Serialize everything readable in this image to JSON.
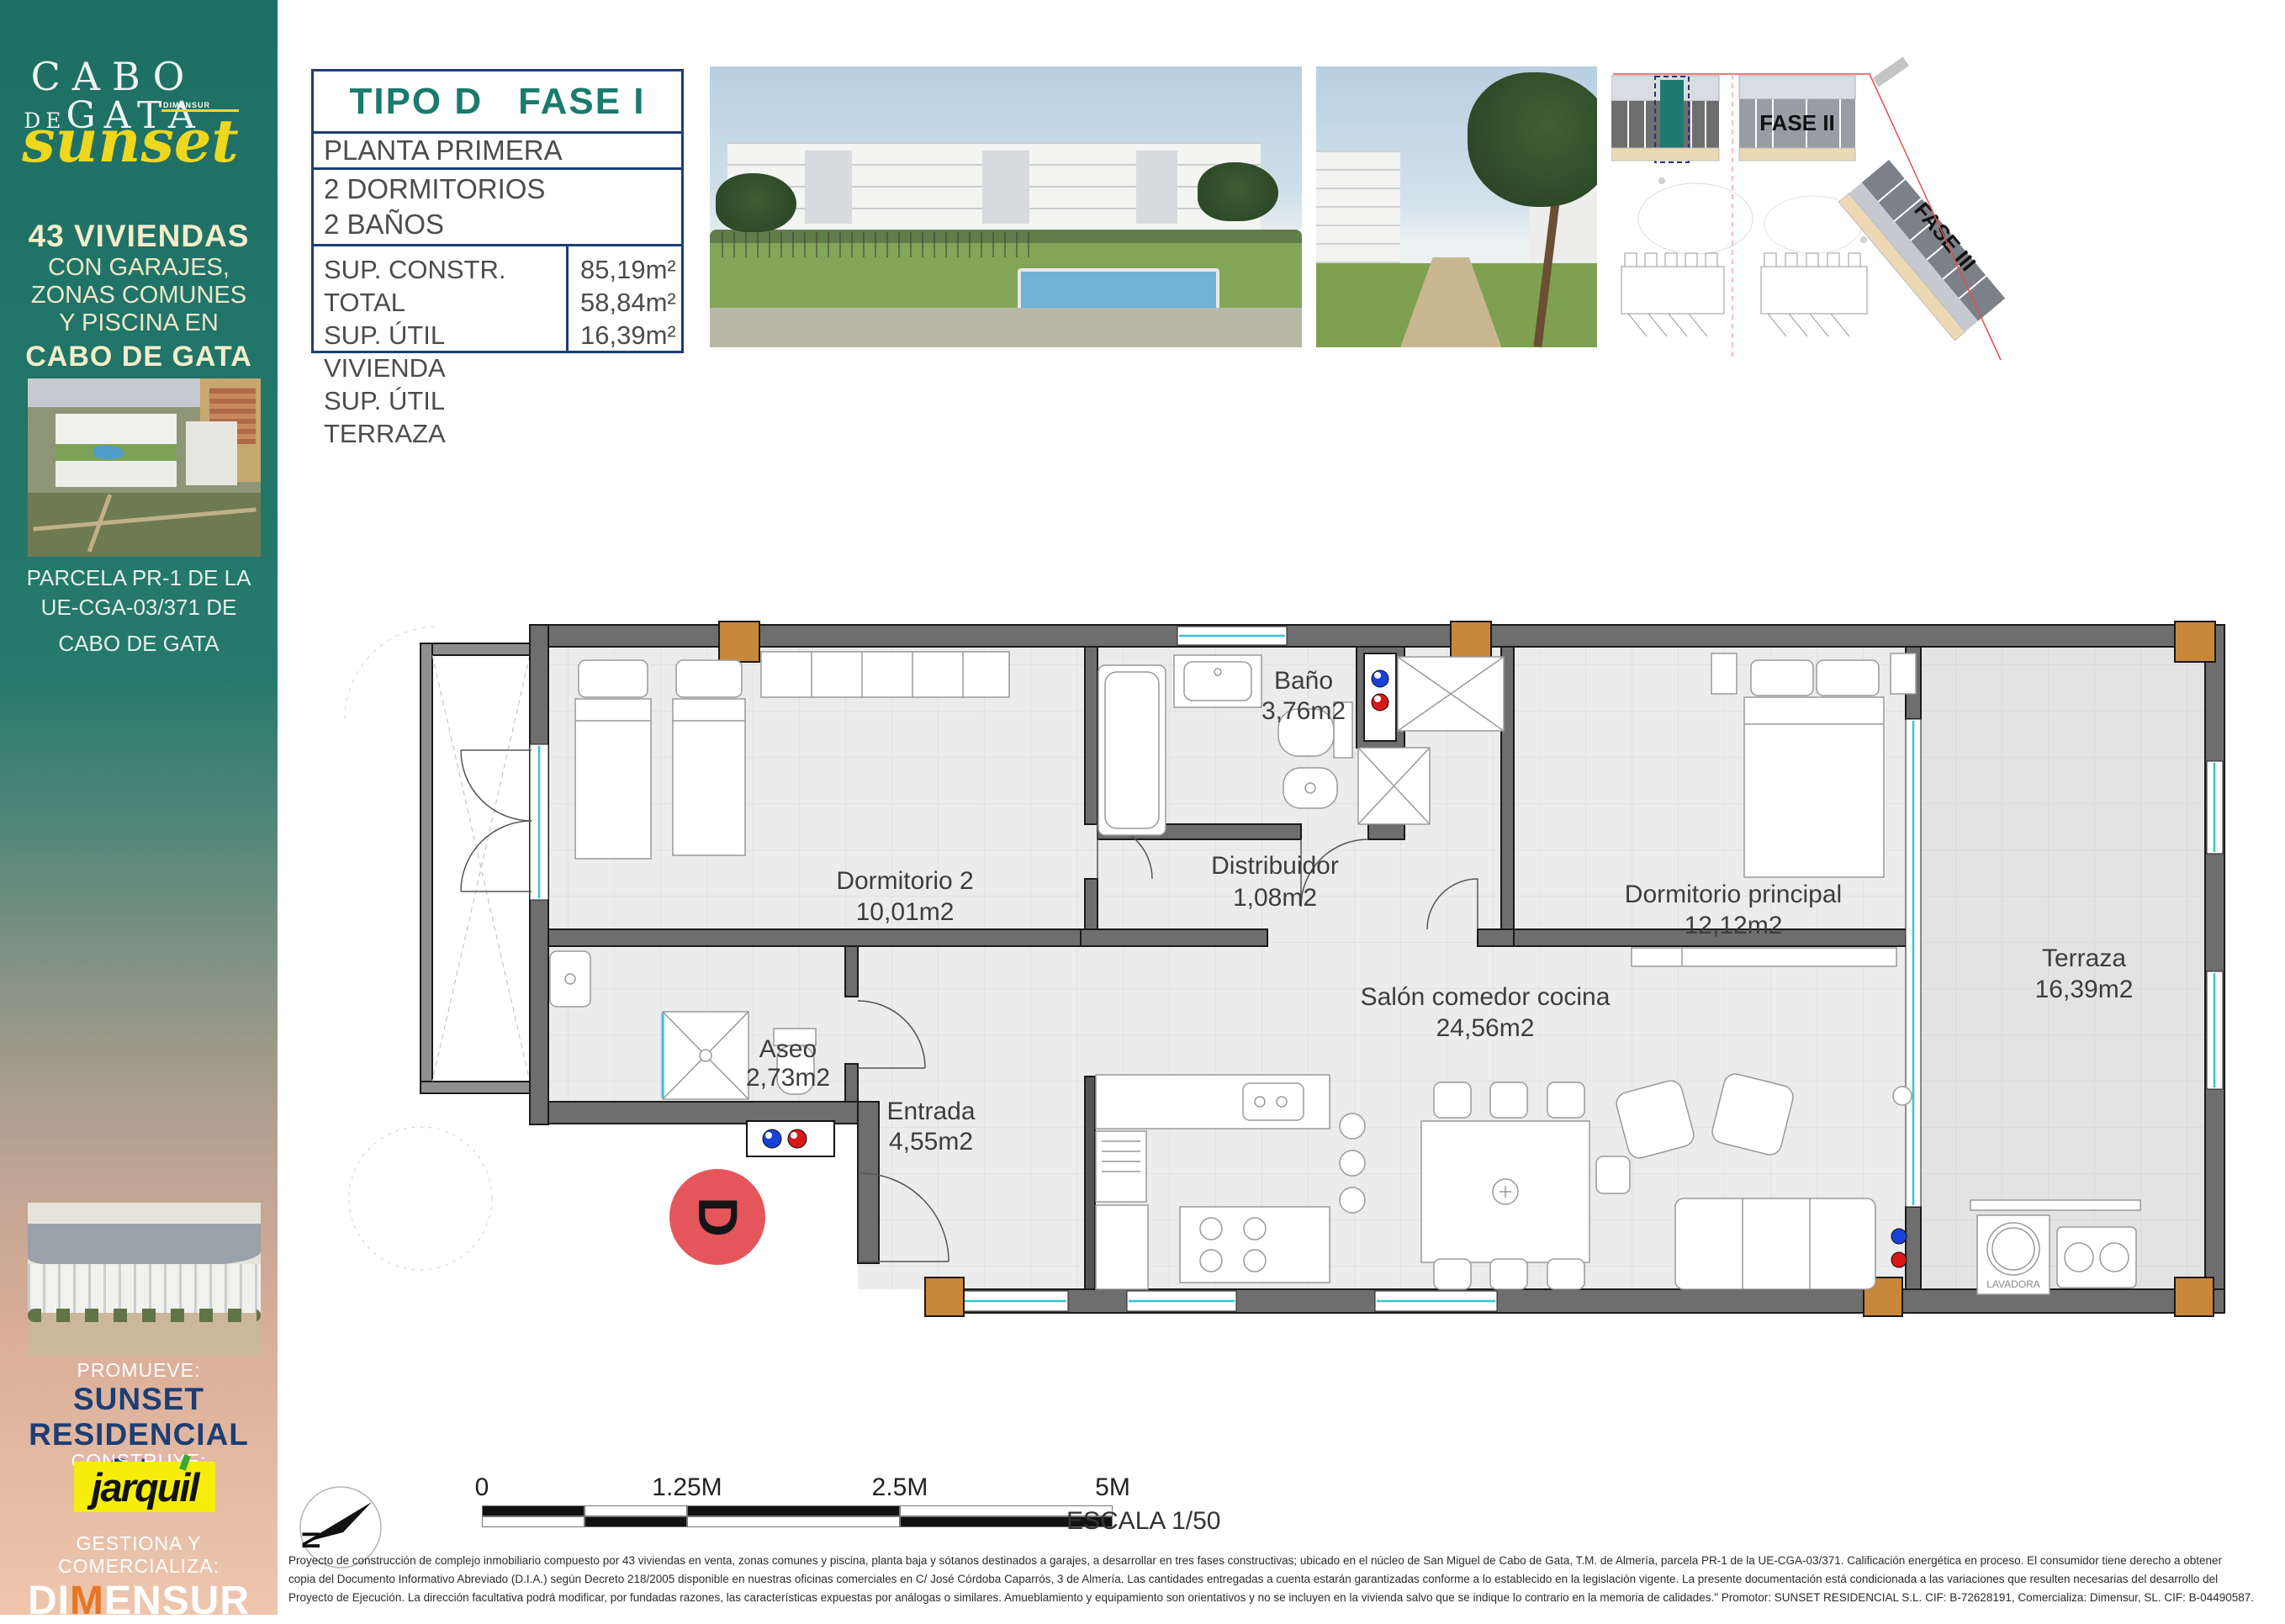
{
  "sidebar": {
    "logo": {
      "cabo": "CABO",
      "de": "DE",
      "gata": "GATA",
      "script": "sunset",
      "byline": "DIMENSUR"
    },
    "headline": {
      "l1": "43 VIVIENDAS",
      "l2": "CON GARAJES,",
      "l3": "ZONAS COMUNES",
      "l4": "Y PISCINA EN",
      "l5": "CABO DE GATA"
    },
    "parcel": {
      "l1": "PARCELA PR-1 DE LA",
      "l2": "UE-CGA-03/371 DE",
      "l3": "CABO DE GATA"
    },
    "promueve_label": "PROMUEVE:",
    "promoter_l1": "SUNSET",
    "promoter_l2": "RESIDENCIAL S.L.",
    "construye_label": "CONSTRUYE:",
    "builder_parts": {
      "a": "jarqu",
      "b": "i",
      "c": "l"
    },
    "gestiona_label": "GESTIONA Y COMERCIALIZA:",
    "agency_parts": {
      "a": "DI",
      "b": "M",
      "c": "ENSUR"
    }
  },
  "info_box": {
    "type_label": "TIPO D",
    "phase_label": "FASE I",
    "floor_label": "PLANTA PRIMERA",
    "bedrooms": "2 DORMITORIOS",
    "bathrooms": "2 BAÑOS",
    "areas": [
      {
        "label": "SUP. CONSTR. TOTAL",
        "value": "85,19m²"
      },
      {
        "label": "SUP. ÚTIL VIVIENDA",
        "value": "58,84m²"
      },
      {
        "label": "SUP. ÚTIL TERRAZA",
        "value": "16,39m²"
      }
    ]
  },
  "site_plan": {
    "fase2_label": "FASE II",
    "fase3_label": "FASE III"
  },
  "floor_plan": {
    "rooms": [
      {
        "name": "Baño",
        "area": "3,76m2"
      },
      {
        "name": "Distribuidor",
        "area": "1,08m2"
      },
      {
        "name": "Dormitorio 2",
        "area": "10,01m2"
      },
      {
        "name": "Dormitorio principal",
        "area": "12,12m2"
      },
      {
        "name": "Salón comedor cocina",
        "area": "24,56m2"
      },
      {
        "name": "Terraza",
        "area": "16,39m2"
      },
      {
        "name": "Aseo",
        "area": "2,73m2"
      },
      {
        "name": "Entrada",
        "area": "4,55m2"
      }
    ],
    "unit_badge": "D",
    "lavadora_label": "LAVADORA"
  },
  "scale_bar": {
    "north_letter": "N",
    "t0": "0",
    "t1": "1.25M",
    "t2": "2.5M",
    "t3": "5M",
    "escala_label": "ESCALA 1/50"
  },
  "disclaimer": {
    "l1": "Proyecto de construcción de complejo inmobiliario compuesto por 43 viviendas en venta, zonas comunes y piscina, planta baja y sótanos destinados a garajes, a desarrollar en tres fases constructivas; ubicado en el núcleo de San Miguel de Cabo de Gata, T.M. de Almería, parcela PR-1 de la UE-CGA-03/371. Calificación energética en proceso. El consumidor tiene derecho a obtener",
    "l2": "copia del Documento Informativo Abreviado (D.I.A.) según Decreto 218/2005 disponible en nuestras oficinas comerciales en C/ José Córdoba Caparrós, 3 de Almería. Las cantidades entregadas a cuenta estarán garantizadas conforme a lo establecido en la legislación vigente. La presente documentación está condicionada a las variaciones que resulten necesarias del desarrollo del",
    "l3": "Proyecto de Ejecución. La dirección facultativa podrá modificar, por fundadas razones, las características expuestas por análogas o similares. Amueblamiento y equipamiento son orientativos y no se incluyen en la vivienda salvo que se indique lo contrario en la memoria de calidades.\" Promotor: SUNSET RESIDENCIAL S.L. CIF: B-72628191, Comercializa: Dimensur, SL. CIF: B-04490587."
  },
  "colors": {
    "teal_accent": "#1a7a6d",
    "navy": "#1c3e72",
    "logo_yellow": "#efd71d",
    "jarquil_yellow": "#f6ee0a",
    "orange": "#e87524",
    "unit_badge_red": "#e4555c",
    "column_orange": "#c9873b",
    "wall_gray": "#6e6e6e"
  }
}
